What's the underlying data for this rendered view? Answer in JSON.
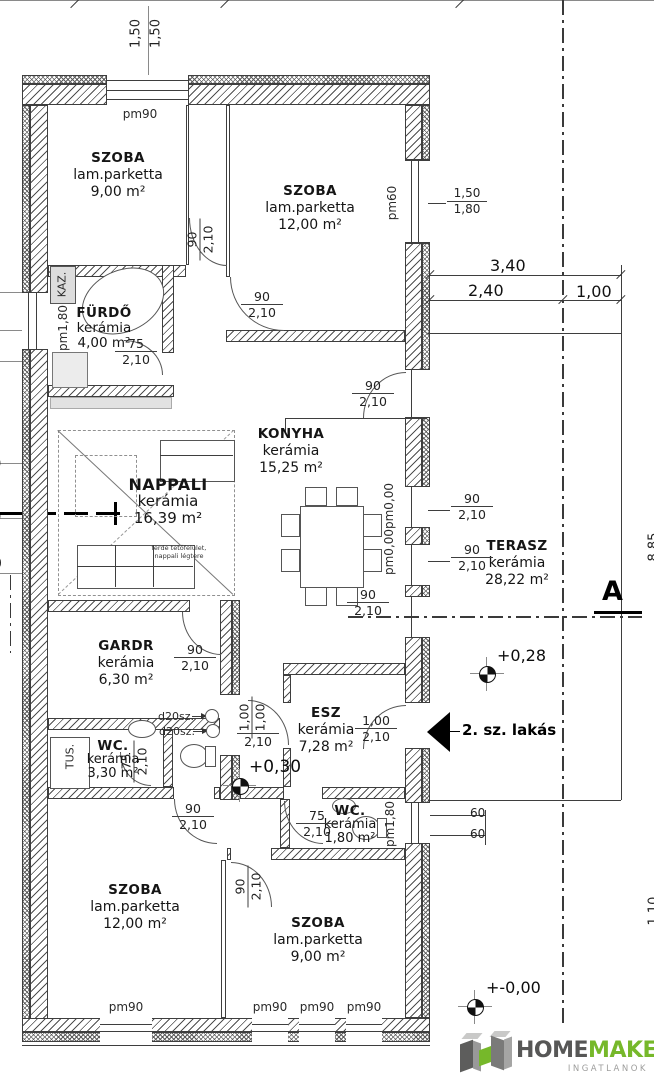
{
  "plan": {
    "rooms": [
      {
        "name": "SZOBA",
        "material": "lam.parketta",
        "area": "9,00 m²"
      },
      {
        "name": "SZOBA",
        "material": "lam.parketta",
        "area": "12,00 m²"
      },
      {
        "name": "FÜRDŐ",
        "material": "kerámia",
        "area": "4,00 m²"
      },
      {
        "name": "KONYHA",
        "material": "kerámia",
        "area": "15,25 m²"
      },
      {
        "name": "NAPPALI",
        "material": "kerámia",
        "area": "16,39 m²"
      },
      {
        "name": "TERASZ",
        "material": "kerámia",
        "area": "28,22 m²"
      },
      {
        "name": "GARDR",
        "material": "kerámia",
        "area": "6,30 m²"
      },
      {
        "name": "WC.",
        "material": "kerámia",
        "area": "3,30 m²"
      },
      {
        "name": "ESZ",
        "material": "kerámia",
        "area": "7,28 m²"
      },
      {
        "name": "WC.",
        "material": "kerámia",
        "area": "1,80 m²"
      }
    ],
    "door_labels": [
      {
        "a": "90",
        "b": "2,10"
      },
      {
        "a": "90",
        "b": "2,10"
      },
      {
        "a": "75",
        "b": "2,10"
      },
      {
        "a": "90",
        "b": "2,10"
      },
      {
        "a": "90",
        "b": "2,10"
      },
      {
        "a": "90",
        "b": "2,10"
      },
      {
        "a": "90",
        "b": "2,10"
      },
      {
        "a": "90",
        "b": "2,10"
      },
      {
        "a": "75",
        "b": "2,10"
      },
      {
        "a": "1,00",
        "b": "1,00",
        "c": "2,10"
      },
      {
        "a": "1,00",
        "b": "2,10"
      },
      {
        "a": "75",
        "b": "2,10"
      },
      {
        "a": "90",
        "b": "2,10"
      },
      {
        "a": "90",
        "b": "2,10"
      }
    ],
    "window_fraction": {
      "a": "1,50",
      "b": "1,80"
    },
    "pm": [
      "pm90",
      "pm60",
      "pm1,80",
      "pm0,00",
      "pm0,00",
      "pm1,80",
      "pm90",
      "pm90",
      "pm90",
      "pm90"
    ],
    "dims": {
      "top": [
        "1,50",
        "1,50"
      ],
      "terrace_total": "3,40",
      "terrace_a": "2,40",
      "terrace_b": "1,00",
      "steps": [
        "60",
        "60"
      ],
      "edge_right": [
        "8,85",
        "1,10"
      ],
      "edge_left": [
        "0",
        "0",
        "0"
      ]
    },
    "levels": [
      "+0,28",
      "+0,30",
      "+-0,00"
    ],
    "section": "A",
    "entrance_label": "2. sz. lakás",
    "equipment": {
      "boiler": "KAZ.",
      "shower": "TUS.",
      "drain1": "d20sz.",
      "drain2": "d20sz."
    },
    "note": [
      "ferde tetőfelület,",
      "nappali légtere"
    ]
  },
  "logo": {
    "home": "HOME",
    "maker": "MAKER",
    "tagline": "INGATLANOK"
  }
}
